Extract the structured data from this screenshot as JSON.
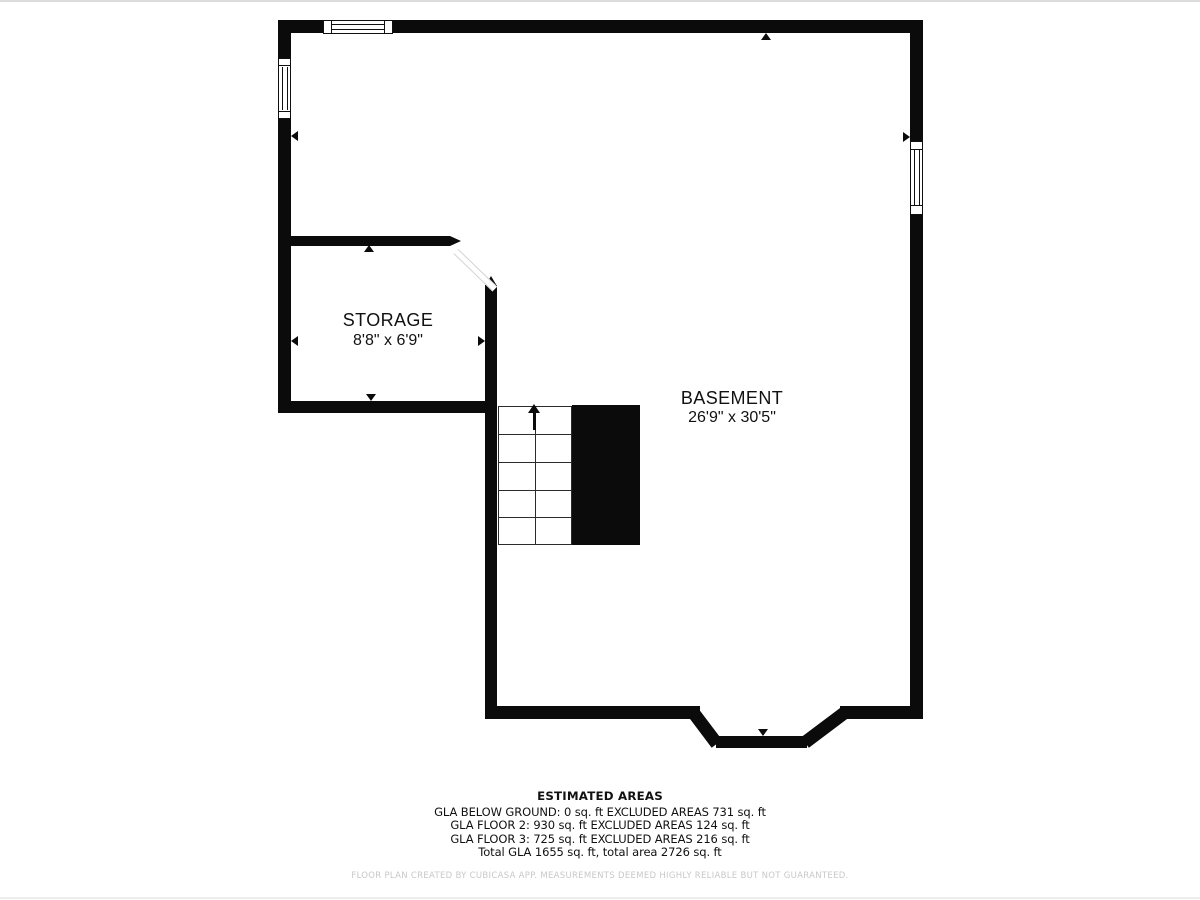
{
  "floor_plan": {
    "rooms": [
      {
        "name": "STORAGE",
        "dimensions": "8'8\" x 6'9\""
      },
      {
        "name": "BASEMENT",
        "dimensions": "26'9\" x 30'5\""
      }
    ],
    "features": [
      "staircase-up",
      "under-stair-block",
      "door-swing",
      "windows",
      "bay-bump-out"
    ]
  },
  "estimated_areas": {
    "title": "ESTIMATED AREAS",
    "lines": [
      "GLA BELOW GROUND: 0 sq. ft EXCLUDED AREAS 731 sq. ft",
      "GLA FLOOR 2: 930 sq. ft EXCLUDED AREAS 124 sq. ft",
      "GLA FLOOR 3: 725 sq. ft EXCLUDED AREAS 216 sq. ft",
      "Total GLA 1655 sq. ft, total area 2726 sq. ft"
    ]
  },
  "footer": {
    "disclaimer": "FLOOR PLAN CREATED BY CUBICASA APP. MEASUREMENTS DEEMED HIGHLY RELIABLE BUT NOT GUARANTEED."
  },
  "colors": {
    "wall": "#0b0b0b",
    "background": "#ffffff",
    "disclaimer_text": "#c8c8c8"
  }
}
